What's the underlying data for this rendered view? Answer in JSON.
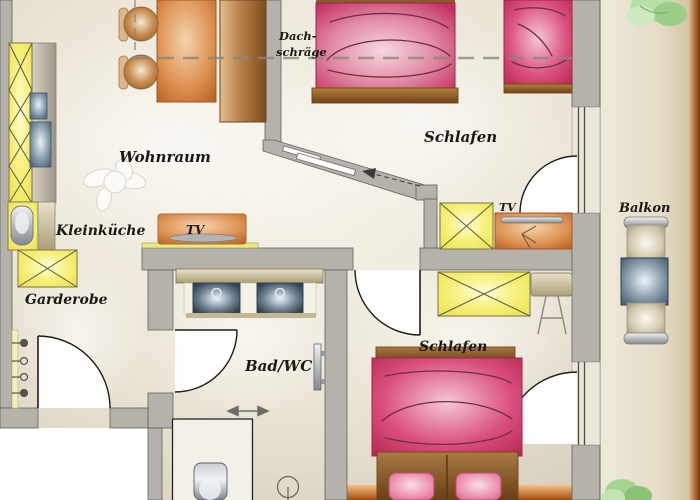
{
  "title": "Apartment floor plan",
  "rooms": [
    {
      "id": "wohnraum",
      "label": "Wohnraum"
    },
    {
      "id": "kleinkueche",
      "label": "Kleinküche"
    },
    {
      "id": "garderobe",
      "label": "Garderobe"
    },
    {
      "id": "schlafen-top",
      "label": "Schlafen"
    },
    {
      "id": "bad-wc",
      "label": "Bad/WC"
    },
    {
      "id": "schlafen-bottom",
      "label": "Schlafen"
    },
    {
      "id": "balkon",
      "label": "Balkon"
    }
  ],
  "annotations": {
    "dachschraege_line1": "Dach-",
    "dachschraege_line2": "schräge",
    "tv_living": "TV",
    "tv_bedroom": "TV"
  },
  "colors": {
    "wall_grey": "#b5b2ac",
    "wall_outline": "#64605a",
    "floor_light": "#f6f3ea",
    "floor_dark": "#d9d2c0",
    "outside_white": "#ffffff",
    "cabinet_yellow": "#f5f077",
    "furniture_orange": "#d98c4c",
    "bed_pink": "#c93a66",
    "bed_frame_brown": "#8a5a2c",
    "appliance_blue_grey": "#7e93a6",
    "balcony_table_slate": "#5d7184",
    "balcony_border_brown": "#8a4a1d",
    "plant_green": "#a9d79a"
  }
}
